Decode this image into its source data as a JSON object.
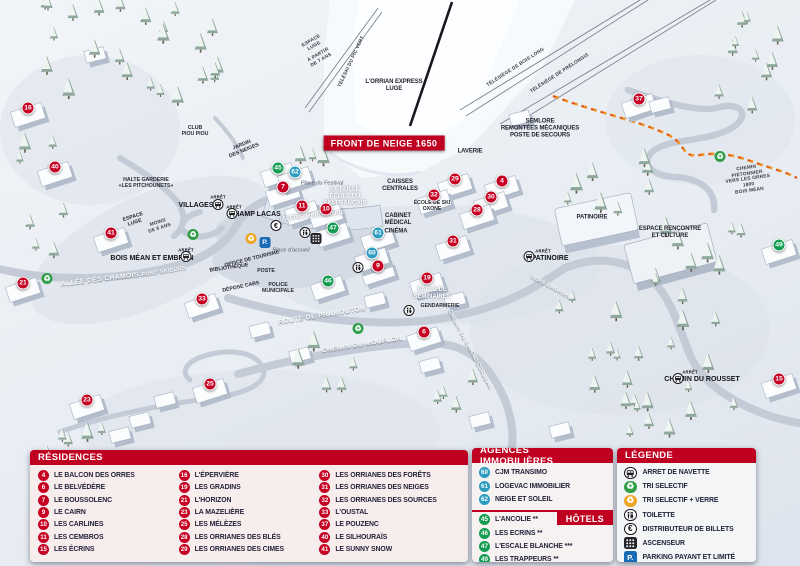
{
  "map": {
    "front_banner": "FRONT DE NEIGE 1650",
    "markers": [
      {
        "n": "16",
        "c": "red",
        "x": 28,
        "y": 108
      },
      {
        "n": "40",
        "c": "red",
        "x": 55,
        "y": 167
      },
      {
        "n": "41",
        "c": "red",
        "x": 111,
        "y": 233
      },
      {
        "n": "21",
        "c": "red",
        "x": 23,
        "y": 283
      },
      {
        "n": "33",
        "c": "red",
        "x": 202,
        "y": 299
      },
      {
        "n": "23",
        "c": "red",
        "x": 87,
        "y": 400
      },
      {
        "n": "25",
        "c": "red",
        "x": 210,
        "y": 384
      },
      {
        "n": "7",
        "c": "red",
        "x": 283,
        "y": 187
      },
      {
        "n": "11",
        "c": "red",
        "x": 302,
        "y": 206
      },
      {
        "n": "10",
        "c": "red",
        "x": 326,
        "y": 209
      },
      {
        "n": "29",
        "c": "red",
        "x": 455,
        "y": 179
      },
      {
        "n": "4",
        "c": "red",
        "x": 502,
        "y": 181
      },
      {
        "n": "32",
        "c": "red",
        "x": 434,
        "y": 195
      },
      {
        "n": "30",
        "c": "red",
        "x": 491,
        "y": 197
      },
      {
        "n": "28",
        "c": "red",
        "x": 477,
        "y": 210
      },
      {
        "n": "31",
        "c": "red",
        "x": 453,
        "y": 241
      },
      {
        "n": "9",
        "c": "red",
        "x": 378,
        "y": 266
      },
      {
        "n": "19",
        "c": "red",
        "x": 427,
        "y": 278
      },
      {
        "n": "6",
        "c": "red",
        "x": 424,
        "y": 332
      },
      {
        "n": "37",
        "c": "red",
        "x": 639,
        "y": 99
      },
      {
        "n": "15",
        "c": "red",
        "x": 779,
        "y": 379
      },
      {
        "n": "45",
        "c": "green",
        "x": 278,
        "y": 168
      },
      {
        "n": "47",
        "c": "green",
        "x": 333,
        "y": 228
      },
      {
        "n": "46",
        "c": "green",
        "x": 328,
        "y": 281
      },
      {
        "n": "49",
        "c": "green",
        "x": 779,
        "y": 245
      },
      {
        "n": "62",
        "c": "blue",
        "x": 295,
        "y": 172
      },
      {
        "n": "61",
        "c": "blue",
        "x": 378,
        "y": 233
      },
      {
        "n": "60",
        "c": "blue",
        "x": 372,
        "y": 253
      }
    ],
    "labels": [
      {
        "t": "ESPACE\nLUGE",
        "x": 313,
        "y": 44,
        "r": -30,
        "v": "lift"
      },
      {
        "t": "À PARTIR\nDE 7 ANS",
        "x": 320,
        "y": 58,
        "r": -30,
        "v": "lift"
      },
      {
        "t": "TÉLÉSKI DU PIC VERT",
        "x": 352,
        "y": 62,
        "r": -65,
        "v": "lift"
      },
      {
        "t": "L'ORRIAN EXPRESS\nLUGE",
        "x": 394,
        "y": 86,
        "v": "poi"
      },
      {
        "t": "TÉLÉSIÈGE DE BOIS LONG",
        "x": 516,
        "y": 68,
        "r": -33,
        "v": "lift"
      },
      {
        "t": "TÉLÉSIÈGE DE PRÉLONGIS",
        "x": 560,
        "y": 74,
        "r": -33,
        "v": "lift"
      },
      {
        "t": "SEMLORE\nREMONTÉES MÉCANIQUES\nPOSTE DE SECOURS",
        "x": 540,
        "y": 129,
        "v": "poi"
      },
      {
        "t": "CLUB\nPIOU PIOU",
        "x": 195,
        "y": 131,
        "v": "poi-sm"
      },
      {
        "t": "JARDIN\nDES NEIGES",
        "x": 243,
        "y": 148,
        "r": -22,
        "v": "poi-sm"
      },
      {
        "t": "HALTE GARDERIE\n«LES PITCHOUNETS»",
        "x": 146,
        "y": 183,
        "v": "poi-sm"
      },
      {
        "t": "ESPACE\nLUGE",
        "x": 134,
        "y": 220,
        "r": -18,
        "v": "poi-sm"
      },
      {
        "t": "MOINS\nDE 6 ANS",
        "x": 159,
        "y": 226,
        "r": -18,
        "v": "lift"
      },
      {
        "t": "VILLAGES",
        "x": 196,
        "y": 206,
        "v": "stop"
      },
      {
        "t": "ARRÊT",
        "x": 218,
        "y": 198,
        "v": "arret"
      },
      {
        "t": "CHAMP LACAS",
        "x": 255,
        "y": 215,
        "v": "stop"
      },
      {
        "t": "ARRÊT",
        "x": 234,
        "y": 208,
        "v": "arret"
      },
      {
        "t": "LAVERIE",
        "x": 470,
        "y": 152,
        "v": "poi"
      },
      {
        "t": "CAISSES\nCENTRALES",
        "x": 400,
        "y": 186,
        "v": "poi"
      },
      {
        "t": "Place du Festival",
        "x": 322,
        "y": 184,
        "v": "italic"
      },
      {
        "t": "LA BULLE\nÉCOLE DU\nSKI FRANÇAIS",
        "x": 345,
        "y": 197,
        "v": "white"
      },
      {
        "t": "GALERIE MARCHANDE",
        "x": 311,
        "y": 217,
        "r": -6,
        "v": "white"
      },
      {
        "t": "CABINET\nMÉDICAL",
        "x": 398,
        "y": 220,
        "v": "poi"
      },
      {
        "t": "CINÉMA",
        "x": 396,
        "y": 232,
        "v": "poi"
      },
      {
        "t": "ÉCOLE DE SKI\nOXONE",
        "x": 432,
        "y": 206,
        "v": "poi-sm"
      },
      {
        "t": "PATINOIRE",
        "x": 592,
        "y": 218,
        "v": "poi"
      },
      {
        "t": "ESPACE RENCONTRE\nET CULTURE",
        "x": 670,
        "y": 233,
        "v": "poi"
      },
      {
        "t": "PATINOIRE",
        "x": 550,
        "y": 259,
        "v": "stop"
      },
      {
        "t": "ARRÊT",
        "x": 543,
        "y": 252,
        "v": "arret"
      },
      {
        "t": "BOIS MÉAN ET EMBRUN",
        "x": 152,
        "y": 259,
        "v": "stop"
      },
      {
        "t": "ARRÊT",
        "x": 186,
        "y": 251,
        "v": "arret"
      },
      {
        "t": "OFFICE DE TOURISME",
        "x": 252,
        "y": 259,
        "r": -14,
        "v": "poi-sm"
      },
      {
        "t": "Place d'accueil",
        "x": 291,
        "y": 251,
        "v": "italic"
      },
      {
        "t": "BIBLIOTHÈQUE",
        "x": 229,
        "y": 268,
        "r": -8,
        "v": "poi-sm"
      },
      {
        "t": "POSTE",
        "x": 266,
        "y": 271,
        "v": "poi-sm"
      },
      {
        "t": "DÉPOSE CARS",
        "x": 241,
        "y": 287,
        "r": -12,
        "v": "poi-sm"
      },
      {
        "t": "POLICE\nMUNICIPALE",
        "x": 278,
        "y": 288,
        "v": "poi-sm"
      },
      {
        "t": "SALLE DE\nSÉMINAIRES",
        "x": 432,
        "y": 294,
        "v": "white"
      },
      {
        "t": "GENDARMERIE",
        "x": 440,
        "y": 306,
        "v": "poi-sm"
      },
      {
        "t": "ALLÉE DES CHAMOIS",
        "x": 100,
        "y": 280,
        "r": -7,
        "v": "road"
      },
      {
        "t": "PONT SKIEURS",
        "x": 164,
        "y": 272,
        "r": -9,
        "v": "road-sm"
      },
      {
        "t": "ROUTE DE PRAMOUTON",
        "x": 322,
        "y": 316,
        "r": -9,
        "v": "road"
      },
      {
        "t": "CHEMIN DU MOUFLON",
        "x": 362,
        "y": 345,
        "r": -9,
        "v": "road"
      },
      {
        "t": "CHEMIN DU GRAND CORBEAU",
        "x": 470,
        "y": 350,
        "r": 62,
        "v": "road-sm"
      },
      {
        "t": "VERS EMBRUN",
        "x": 550,
        "y": 287,
        "r": 28,
        "v": "road-sm"
      },
      {
        "t": "CHEMIN PIÉTONNIER\nVERS LES ORRES 1800\nBOIS MÉAN",
        "x": 748,
        "y": 180,
        "r": -8,
        "v": "lift"
      },
      {
        "t": "CHEMIN DU ROUSSET",
        "x": 702,
        "y": 380,
        "v": "stop"
      },
      {
        "t": "ARRÊT",
        "x": 690,
        "y": 373,
        "v": "arret"
      }
    ],
    "icons": [
      {
        "name": "bus-icon",
        "x": 218,
        "y": 205
      },
      {
        "name": "bus-icon",
        "x": 232,
        "y": 214
      },
      {
        "name": "bus-icon",
        "x": 186,
        "y": 257
      },
      {
        "name": "bus-icon",
        "x": 529,
        "y": 257
      },
      {
        "name": "bus-icon",
        "x": 678,
        "y": 379
      },
      {
        "name": "recycle-green-icon",
        "x": 193,
        "y": 233
      },
      {
        "name": "recycle-green-icon",
        "x": 47,
        "y": 277
      },
      {
        "name": "recycle-green-icon",
        "x": 358,
        "y": 327
      },
      {
        "name": "recycle-green-icon",
        "x": 720,
        "y": 155
      },
      {
        "name": "recycle-glass-icon",
        "x": 251,
        "y": 237
      },
      {
        "name": "parking-icon",
        "x": 265,
        "y": 240
      },
      {
        "name": "euro-icon",
        "x": 276,
        "y": 224
      },
      {
        "name": "toilet-icon",
        "x": 305,
        "y": 233
      },
      {
        "name": "toilet-icon",
        "x": 358,
        "y": 268
      },
      {
        "name": "toilet-icon",
        "x": 409,
        "y": 311
      },
      {
        "name": "elevator-icon",
        "x": 316,
        "y": 240
      }
    ]
  },
  "panels": {
    "residences": {
      "title": "RÉSIDENCES",
      "items": [
        {
          "n": "4",
          "label": "LE BALCON DES ORRES"
        },
        {
          "n": "6",
          "label": "LE BELVÉDÈRE"
        },
        {
          "n": "7",
          "label": "LE BOUSSOLENC"
        },
        {
          "n": "9",
          "label": "LE CAIRN"
        },
        {
          "n": "10",
          "label": "LES CARLINES"
        },
        {
          "n": "11",
          "label": "LES CEMBROS"
        },
        {
          "n": "15",
          "label": "LES ÉCRINS"
        },
        {
          "n": "16",
          "label": "L'ÉPERVIÈRE"
        },
        {
          "n": "19",
          "label": "LES GRADINS"
        },
        {
          "n": "21",
          "label": "L'HORIZON"
        },
        {
          "n": "23",
          "label": "LA MAZELIÈRE"
        },
        {
          "n": "25",
          "label": "LES MÉLÈZES"
        },
        {
          "n": "28",
          "label": "LES ORRIANES DES BLÉS"
        },
        {
          "n": "29",
          "label": "LES ORRIANES DES CIMES"
        },
        {
          "n": "30",
          "label": "LES ORRIANES DES FORÊTS"
        },
        {
          "n": "31",
          "label": "LES ORRIANES DES NEIGES"
        },
        {
          "n": "32",
          "label": "LES ORRIANES DES SOURCES"
        },
        {
          "n": "33",
          "label": "L'OUSTAL"
        },
        {
          "n": "37",
          "label": "LE POUZENC"
        },
        {
          "n": "40",
          "label": "LE SILHOURAÏS"
        },
        {
          "n": "41",
          "label": "LE SUNNY SNOW"
        }
      ]
    },
    "agences": {
      "title": "AGENCES IMMOBILIÈRES",
      "items": [
        {
          "n": "60",
          "label": "CJM TRANSIMO"
        },
        {
          "n": "61",
          "label": "LOGEVAC IMMOBILIER"
        },
        {
          "n": "62",
          "label": "NEIGE ET SOLEIL"
        }
      ]
    },
    "hotels": {
      "title": "HÔTELS",
      "items": [
        {
          "n": "45",
          "label": "L'ANCOLIE **"
        },
        {
          "n": "46",
          "label": "LES ECRINS **"
        },
        {
          "n": "47",
          "label": "L'ESCALE BLANCHE ***"
        },
        {
          "n": "49",
          "label": "LES TRAPPEURS **"
        }
      ]
    },
    "legende": {
      "title": "LÉGENDE",
      "items": [
        {
          "icon": "bus-icon",
          "label": "ARRET DE NAVETTE"
        },
        {
          "icon": "recycle-green-icon",
          "label": "TRI SELECTIF"
        },
        {
          "icon": "recycle-glass-icon",
          "label": "TRI SELECTIF + VERRE"
        },
        {
          "icon": "toilet-icon",
          "label": "TOILETTE"
        },
        {
          "icon": "euro-icon",
          "label": "DISTRIBUTEUR DE BILLETS"
        },
        {
          "icon": "elevator-icon",
          "label": "ASCENSEUR"
        },
        {
          "icon": "parking-icon",
          "label": "PARKING PAYANT ET LIMITÉ"
        }
      ]
    }
  },
  "colors": {
    "accent_red": "#c00021",
    "marker_blue": "#2b9cc0",
    "marker_green": "#119c50",
    "parking_blue": "#1a6bb5"
  }
}
